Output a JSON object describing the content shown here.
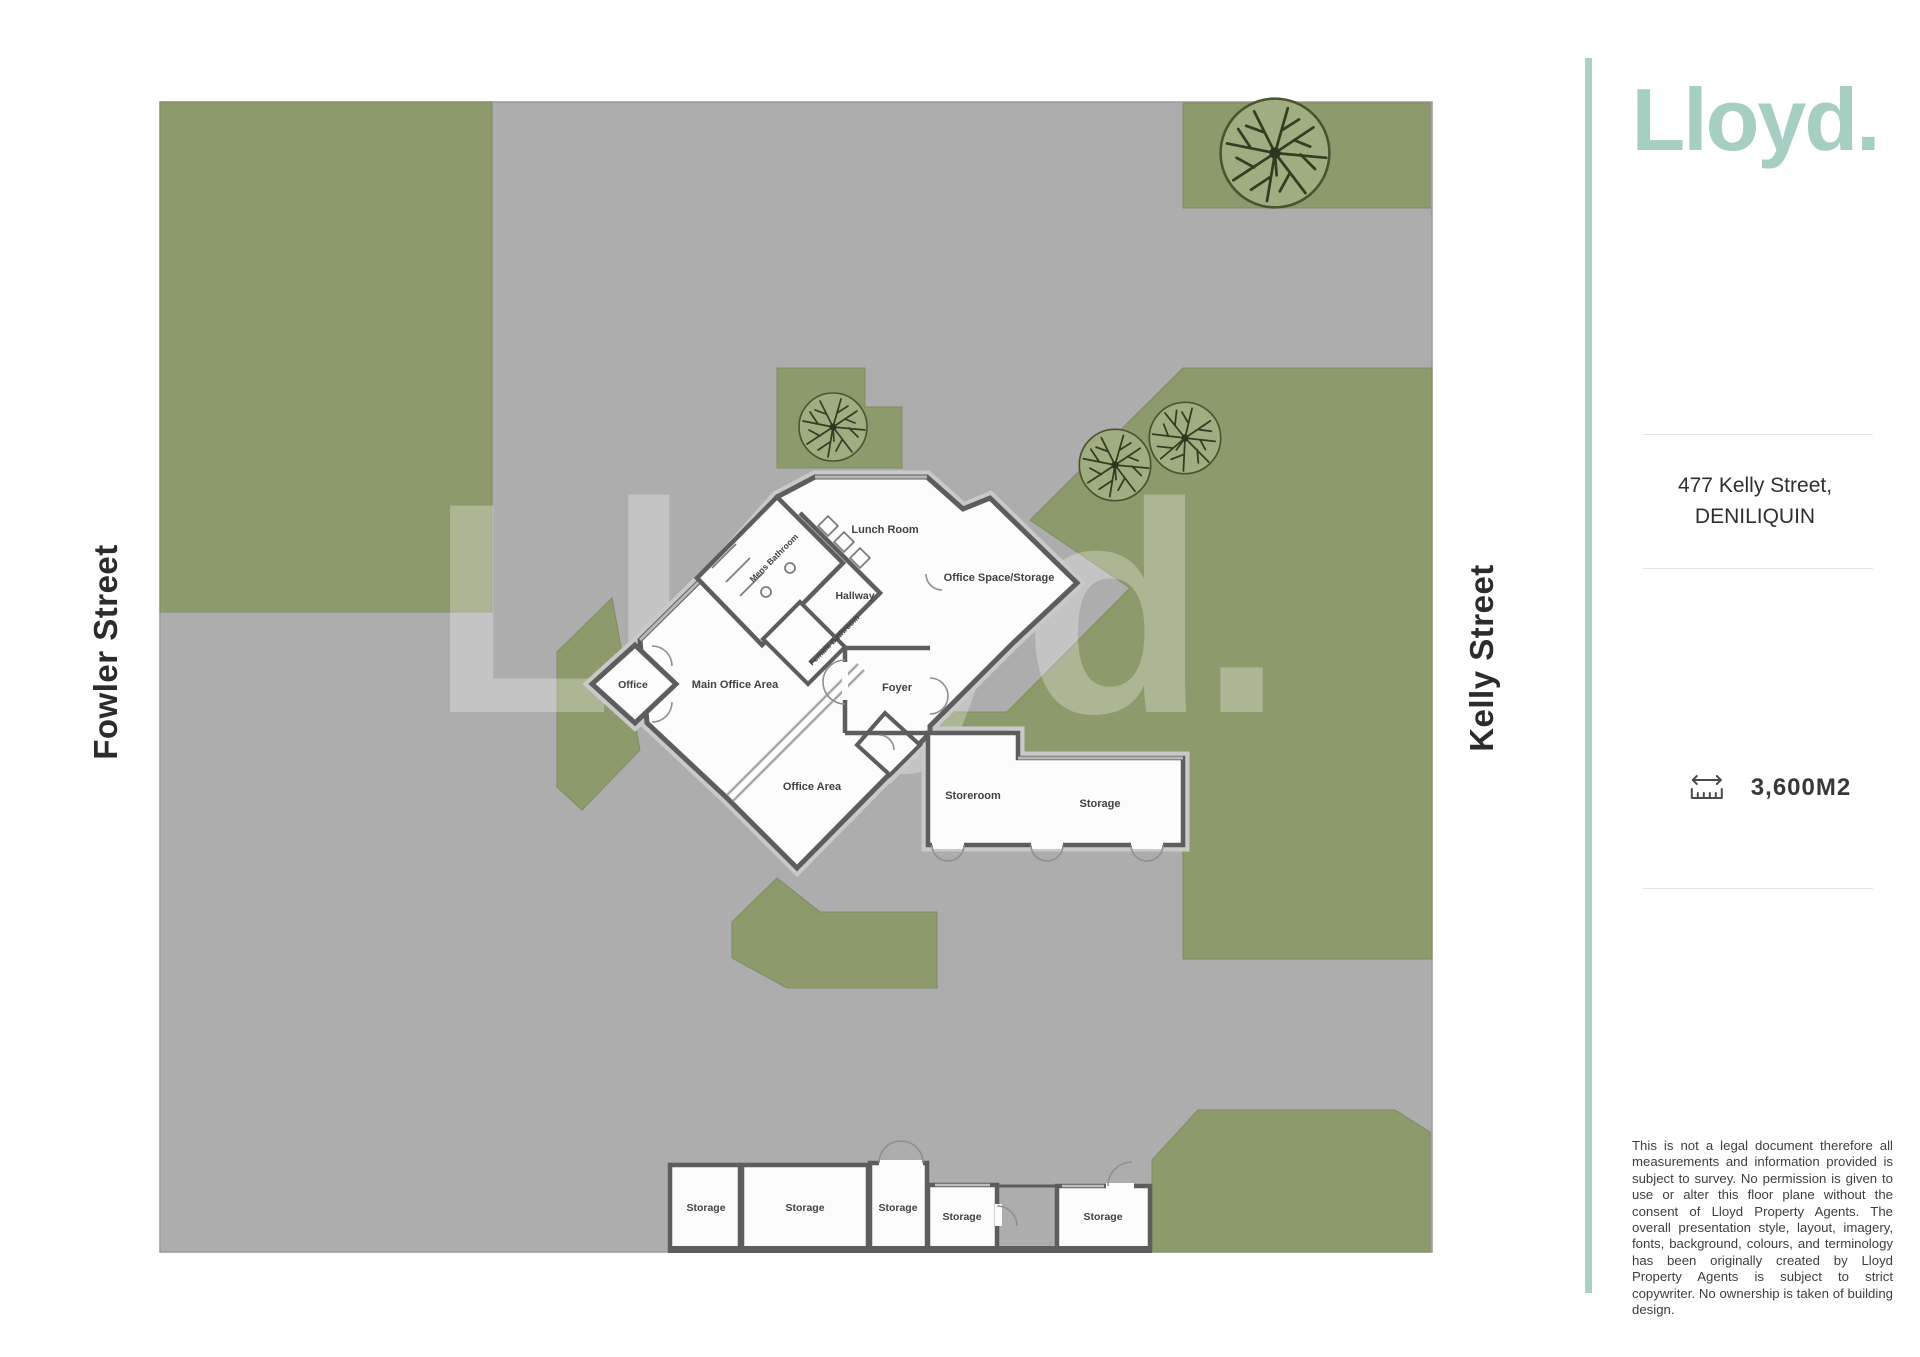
{
  "brand": {
    "logo": "Lloyd."
  },
  "colors": {
    "accent_teal": "#abd0c4",
    "grass_green": "#8c9a6c",
    "pavement_gray": "#adadad",
    "wall_dark": "#5d5d5d",
    "path_buffer": "#c9c9c9"
  },
  "streets": {
    "left": "Fowler Street",
    "right": "Kelly Street"
  },
  "watermark": "Lloyd.",
  "property": {
    "address_line1": "477 Kelly Street,",
    "address_line2": "DENILIQUIN",
    "land_area": "3,600M2"
  },
  "rooms": {
    "lunch_room": "Lunch Room",
    "office_space_storage": "Office Space/Storage",
    "hallway": "Hallway",
    "mens_bathroom": "Mens Bathroom",
    "female_bathroom": "Female Bathroom",
    "office": "Office",
    "main_office_area": "Main Office Area",
    "foyer": "Foyer",
    "office_area": "Office Area"
  },
  "outbuildings": {
    "storeroom": "Storeroom",
    "storage": "Storage",
    "bottom_row": [
      "Storage",
      "Storage",
      "Storage",
      "Storage",
      "Storage"
    ]
  },
  "disclaimer": "This is not a legal document therefore all measurements and information provided is subject to survey. No permission is given to use or alter this floor plane without the consent of Lloyd Property Agents. The overall presentation style, layout, imagery, fonts, background, colours, and terminology has been originally created by Lloyd Property Agents is subject to strict copywriter. No ownership is taken of building design."
}
